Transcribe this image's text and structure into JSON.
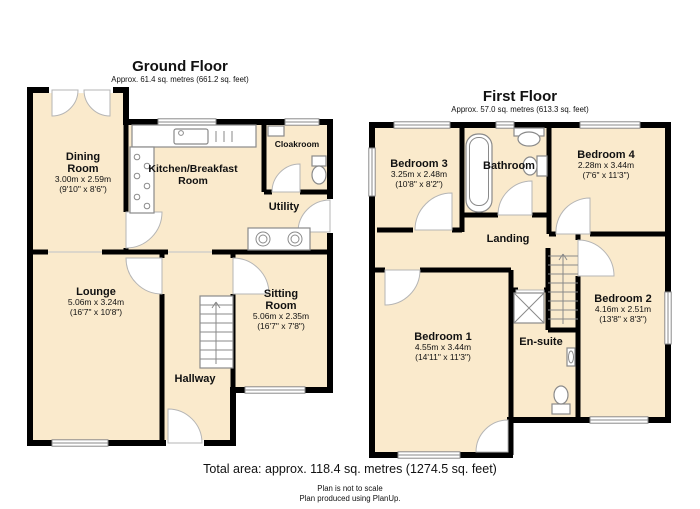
{
  "colors": {
    "room_fill": "#faeacc",
    "wall": "#000000",
    "fixture": "#8a8a8a",
    "arc": "#b5b5b5",
    "open": "#c9c9c9",
    "text": "#111111"
  },
  "ground_floor": {
    "title": "Ground Floor",
    "subtitle": "Approx. 61.4 sq. metres (661.2 sq. feet)",
    "rooms": [
      {
        "name": "Dining Room",
        "size_m": "3.00m x 2.59m",
        "size_ft": "(9'10\" x 8'6\")"
      },
      {
        "name": "Kitchen/Breakfast Room",
        "size_m": "",
        "size_ft": ""
      },
      {
        "name": "Cloakroom",
        "size_m": "",
        "size_ft": ""
      },
      {
        "name": "Utility",
        "size_m": "",
        "size_ft": ""
      },
      {
        "name": "Lounge",
        "size_m": "5.06m x 3.24m",
        "size_ft": "(16'7\" x 10'8\")"
      },
      {
        "name": "Sitting Room",
        "size_m": "5.06m x 2.35m",
        "size_ft": "(16'7\" x 7'8\")"
      },
      {
        "name": "Hallway",
        "size_m": "",
        "size_ft": ""
      }
    ]
  },
  "first_floor": {
    "title": "First Floor",
    "subtitle": "Approx. 57.0 sq. metres (613.3 sq. feet)",
    "rooms": [
      {
        "name": "Bedroom 3",
        "size_m": "3.25m x 2.48m",
        "size_ft": "(10'8\" x 8'2\")"
      },
      {
        "name": "Bathroom",
        "size_m": "",
        "size_ft": ""
      },
      {
        "name": "Bedroom 4",
        "size_m": "2.28m x 3.44m",
        "size_ft": "(7'6\" x 11'3\")"
      },
      {
        "name": "Landing",
        "size_m": "",
        "size_ft": ""
      },
      {
        "name": "Bedroom 2",
        "size_m": "4.16m x 2.51m",
        "size_ft": "(13'8\" x 8'3\")"
      },
      {
        "name": "Bedroom 1",
        "size_m": "4.55m x 3.44m",
        "size_ft": "(14'11\" x 11'3\")"
      },
      {
        "name": "En-suite",
        "size_m": "",
        "size_ft": ""
      }
    ]
  },
  "footer": {
    "total": "Total area: approx. 118.4 sq. metres (1274.5 sq. feet)",
    "note1": "Plan is not to scale",
    "note2": "Plan produced using PlanUp."
  }
}
